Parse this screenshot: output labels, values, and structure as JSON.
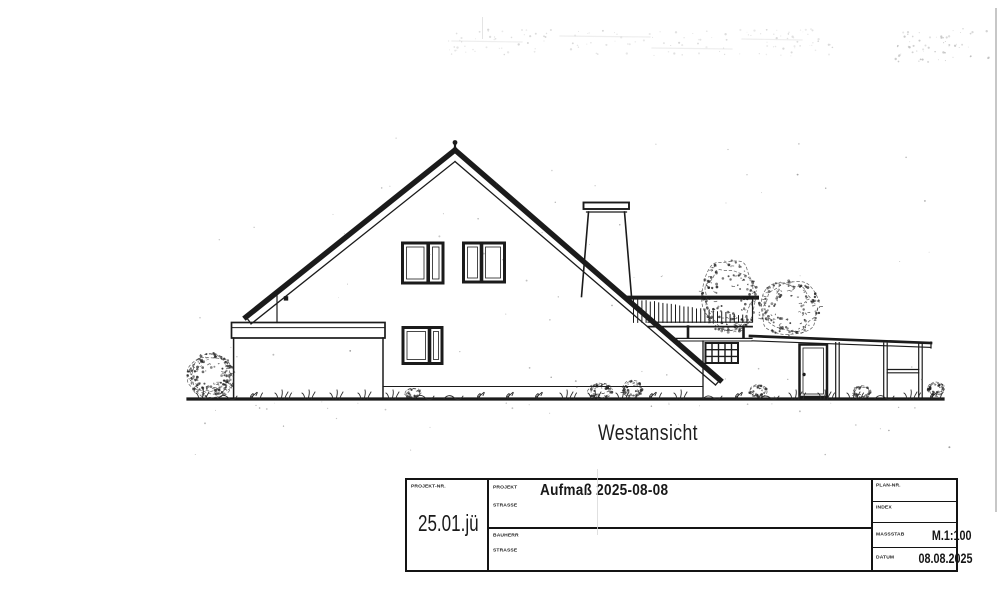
{
  "drawing": {
    "caption": "Westansicht"
  },
  "title_block": {
    "projekt_nr_label": "PROJEKT-NR.",
    "projekt_nr_value": "25.01.jü",
    "projekt_label": "PROJEKT",
    "projekt_value": "Aufmaß 2025-08-08",
    "strasse_label_1": "STRASSE",
    "bauherr_label": "BAUHERR",
    "strasse_label_2": "STRASSE",
    "plan_nr_label": "PLAN-NR.",
    "index_label": "INDEX",
    "massstab_label": "MASSSTAB",
    "massstab_value": "M.1:100",
    "datum_label": "DATUM",
    "datum_value": "08.08.2025"
  },
  "colors": {
    "ink": "#1b1b1b",
    "paper": "#ffffff"
  }
}
